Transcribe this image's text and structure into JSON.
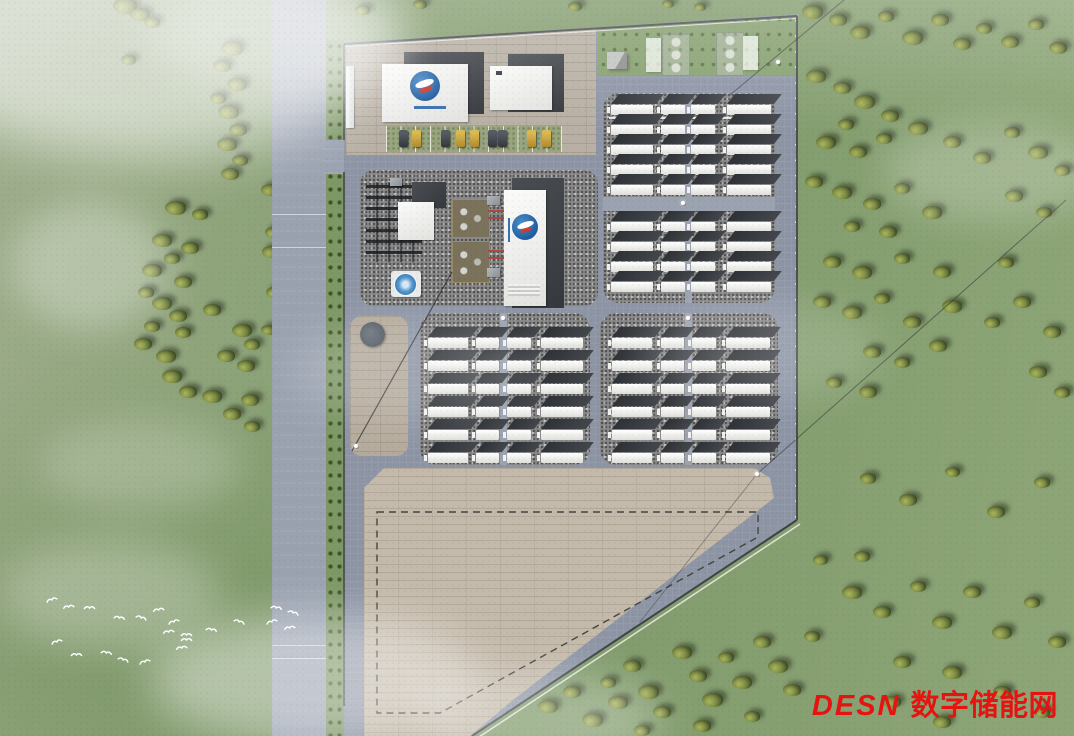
{
  "watermark": {
    "brand": "DESN",
    "cn": "数字储能网",
    "color": "#e51410"
  },
  "scene": {
    "description": "aerial-render-of-energy-storage-power-station",
    "colors": {
      "grass": "#86a071",
      "road": "#9aa2b0",
      "site": "#8d95a5",
      "gravel": "#8a8a8a",
      "paver": "#b5ab9d",
      "tan_pad": "#c4baab",
      "container_white": "#f2f2f0",
      "container_roof": "#2e3135",
      "logo_blue": "#1d5a9e",
      "logo_red": "#d23c2a",
      "watermark_red": "#e51410"
    },
    "battery_blocks": [
      {
        "name": "battery-yard-north",
        "left": 603,
        "top": 93,
        "width": 172,
        "height": 210,
        "radius": 16,
        "cols": [
          [
            8,
            42
          ],
          [
            58,
            24
          ],
          [
            88,
            24
          ],
          [
            124,
            44
          ]
        ],
        "rows": [
          12,
          32,
          52,
          72,
          92,
          129,
          149,
          169,
          189
        ],
        "vroad": {
          "x": 82,
          "w": 7
        },
        "hroad": {
          "y": 104,
          "h": 14
        },
        "tray": {
          "y": 24
        }
      },
      {
        "name": "battery-yard-southwest",
        "left": 420,
        "top": 313,
        "width": 170,
        "height": 152,
        "radius": 16,
        "cols": [
          [
            8,
            40
          ],
          [
            56,
            23
          ],
          [
            87,
            24
          ],
          [
            121,
            42
          ]
        ],
        "rows": [
          25,
          48,
          71,
          94,
          117,
          140
        ],
        "vroad": {
          "x": 80,
          "w": 7
        }
      },
      {
        "name": "battery-yard-southeast",
        "left": 600,
        "top": 313,
        "width": 178,
        "height": 152,
        "radius": 16,
        "cols": [
          [
            12,
            40
          ],
          [
            61,
            23
          ],
          [
            92,
            24
          ],
          [
            126,
            44
          ]
        ],
        "rows": [
          25,
          48,
          71,
          94,
          117,
          140
        ],
        "vroad": {
          "x": 85,
          "w": 7
        }
      }
    ],
    "cars": [
      [
        399,
        "dark"
      ],
      [
        412,
        "gold"
      ],
      [
        441,
        "dark"
      ],
      [
        456,
        "gold"
      ],
      [
        470,
        "gold"
      ],
      [
        488,
        "dark"
      ],
      [
        498,
        "dark"
      ],
      [
        527,
        "gold"
      ],
      [
        542,
        "gold"
      ]
    ],
    "car_y": 130,
    "poles": [
      [
        356,
        446
      ],
      [
        757,
        474
      ],
      [
        778,
        62
      ],
      [
        683,
        203
      ],
      [
        503,
        318
      ],
      [
        688,
        318
      ]
    ],
    "road_seams": [
      214,
      247,
      645,
      658
    ],
    "trees": [
      [
        125,
        6,
        16
      ],
      [
        140,
        14,
        13
      ],
      [
        152,
        22,
        11
      ],
      [
        128,
        60,
        10
      ],
      [
        232,
        48,
        15
      ],
      [
        222,
        66,
        12
      ],
      [
        237,
        84,
        13
      ],
      [
        218,
        98,
        11
      ],
      [
        228,
        112,
        14
      ],
      [
        238,
        130,
        12
      ],
      [
        227,
        144,
        13
      ],
      [
        240,
        160,
        11
      ],
      [
        230,
        174,
        12
      ],
      [
        175,
        208,
        14
      ],
      [
        200,
        214,
        11
      ],
      [
        162,
        240,
        13
      ],
      [
        190,
        248,
        12
      ],
      [
        172,
        258,
        11
      ],
      [
        152,
        270,
        13
      ],
      [
        183,
        282,
        12
      ],
      [
        146,
        292,
        11
      ],
      [
        162,
        303,
        13
      ],
      [
        178,
        316,
        12
      ],
      [
        152,
        326,
        11
      ],
      [
        143,
        344,
        12
      ],
      [
        166,
        356,
        13
      ],
      [
        183,
        332,
        11
      ],
      [
        212,
        310,
        12
      ],
      [
        242,
        330,
        13
      ],
      [
        252,
        344,
        11
      ],
      [
        226,
        356,
        12
      ],
      [
        246,
        366,
        12
      ],
      [
        172,
        376,
        13
      ],
      [
        188,
        392,
        12
      ],
      [
        212,
        396,
        13
      ],
      [
        250,
        400,
        12
      ],
      [
        232,
        414,
        12
      ],
      [
        252,
        426,
        11
      ],
      [
        270,
        190,
        12
      ],
      [
        273,
        232,
        11
      ],
      [
        271,
        252,
        12
      ],
      [
        274,
        292,
        11
      ],
      [
        268,
        330,
        10
      ],
      [
        362,
        10,
        10
      ],
      [
        420,
        4,
        9
      ],
      [
        575,
        6,
        9
      ],
      [
        668,
        4,
        8
      ],
      [
        700,
        7,
        8
      ],
      [
        812,
        12,
        14
      ],
      [
        838,
        20,
        12
      ],
      [
        860,
        32,
        13
      ],
      [
        886,
        16,
        11
      ],
      [
        912,
        38,
        14
      ],
      [
        940,
        20,
        12
      ],
      [
        962,
        44,
        12
      ],
      [
        984,
        28,
        11
      ],
      [
        1010,
        42,
        12
      ],
      [
        1036,
        24,
        11
      ],
      [
        1058,
        48,
        12
      ],
      [
        816,
        76,
        13
      ],
      [
        842,
        88,
        12
      ],
      [
        864,
        102,
        14
      ],
      [
        890,
        116,
        12
      ],
      [
        846,
        124,
        11
      ],
      [
        826,
        142,
        13
      ],
      [
        858,
        152,
        12
      ],
      [
        884,
        138,
        11
      ],
      [
        918,
        128,
        13
      ],
      [
        952,
        142,
        12
      ],
      [
        982,
        158,
        12
      ],
      [
        1012,
        132,
        11
      ],
      [
        1038,
        152,
        13
      ],
      [
        1062,
        170,
        11
      ],
      [
        814,
        182,
        12
      ],
      [
        842,
        192,
        13
      ],
      [
        872,
        204,
        12
      ],
      [
        902,
        188,
        11
      ],
      [
        932,
        212,
        13
      ],
      [
        852,
        226,
        11
      ],
      [
        888,
        232,
        12
      ],
      [
        1014,
        196,
        12
      ],
      [
        1044,
        212,
        11
      ],
      [
        832,
        262,
        12
      ],
      [
        862,
        272,
        13
      ],
      [
        902,
        258,
        11
      ],
      [
        942,
        272,
        12
      ],
      [
        1006,
        262,
        11
      ],
      [
        822,
        302,
        12
      ],
      [
        852,
        312,
        13
      ],
      [
        882,
        298,
        11
      ],
      [
        912,
        322,
        12
      ],
      [
        952,
        306,
        13
      ],
      [
        992,
        322,
        11
      ],
      [
        1022,
        302,
        12
      ],
      [
        1052,
        332,
        12
      ],
      [
        872,
        352,
        12
      ],
      [
        902,
        362,
        11
      ],
      [
        938,
        346,
        12
      ],
      [
        834,
        382,
        11
      ],
      [
        868,
        392,
        12
      ],
      [
        1038,
        372,
        12
      ],
      [
        1062,
        392,
        11
      ],
      [
        868,
        478,
        11
      ],
      [
        908,
        500,
        12
      ],
      [
        952,
        472,
        10
      ],
      [
        996,
        512,
        12
      ],
      [
        1042,
        482,
        11
      ],
      [
        548,
        706,
        13
      ],
      [
        572,
        692,
        12
      ],
      [
        592,
        720,
        14
      ],
      [
        608,
        682,
        11
      ],
      [
        618,
        702,
        13
      ],
      [
        632,
        666,
        12
      ],
      [
        648,
        692,
        14
      ],
      [
        662,
        712,
        12
      ],
      [
        642,
        730,
        11
      ],
      [
        682,
        652,
        13
      ],
      [
        698,
        676,
        12
      ],
      [
        712,
        700,
        14
      ],
      [
        726,
        657,
        11
      ],
      [
        742,
        682,
        13
      ],
      [
        762,
        642,
        12
      ],
      [
        778,
        666,
        13
      ],
      [
        792,
        690,
        12
      ],
      [
        812,
        636,
        11
      ],
      [
        702,
        726,
        12
      ],
      [
        752,
        716,
        11
      ],
      [
        852,
        592,
        13
      ],
      [
        882,
        612,
        12
      ],
      [
        918,
        586,
        11
      ],
      [
        942,
        622,
        13
      ],
      [
        972,
        592,
        12
      ],
      [
        1002,
        632,
        13
      ],
      [
        1032,
        602,
        11
      ],
      [
        1057,
        642,
        12
      ],
      [
        902,
        662,
        12
      ],
      [
        952,
        672,
        13
      ],
      [
        1002,
        692,
        12
      ],
      [
        1042,
        712,
        11
      ],
      [
        892,
        702,
        12
      ],
      [
        942,
        722,
        12
      ],
      [
        862,
        556,
        11
      ],
      [
        820,
        560,
        10
      ]
    ],
    "birds": [
      [
        45,
        590
      ],
      [
        62,
        597
      ],
      [
        83,
        598
      ],
      [
        113,
        608
      ],
      [
        135,
        608
      ],
      [
        167,
        612
      ],
      [
        162,
        622
      ],
      [
        180,
        625
      ],
      [
        205,
        620
      ],
      [
        233,
        612
      ],
      [
        265,
        612
      ],
      [
        283,
        618
      ],
      [
        70,
        645
      ],
      [
        100,
        643
      ],
      [
        117,
        650
      ],
      [
        138,
        652
      ],
      [
        175,
        638
      ],
      [
        180,
        630
      ],
      [
        270,
        598
      ],
      [
        287,
        603
      ],
      [
        50,
        632
      ],
      [
        152,
        600
      ]
    ],
    "clouds": [
      [
        -90,
        -70,
        480,
        230,
        0.55,
        26
      ],
      [
        150,
        -20,
        260,
        110,
        0.3,
        20
      ],
      [
        10,
        200,
        160,
        130,
        0.3,
        18
      ],
      [
        150,
        615,
        330,
        130,
        0.42,
        22
      ],
      [
        420,
        670,
        240,
        100,
        0.3,
        20
      ],
      [
        884,
        120,
        220,
        100,
        0.22,
        18
      ],
      [
        640,
        300,
        240,
        100,
        0.14,
        18
      ],
      [
        290,
        320,
        240,
        100,
        0.16,
        18
      ],
      [
        40,
        420,
        200,
        90,
        0.2,
        18
      ],
      [
        0,
        540,
        220,
        110,
        0.25,
        20
      ]
    ]
  }
}
